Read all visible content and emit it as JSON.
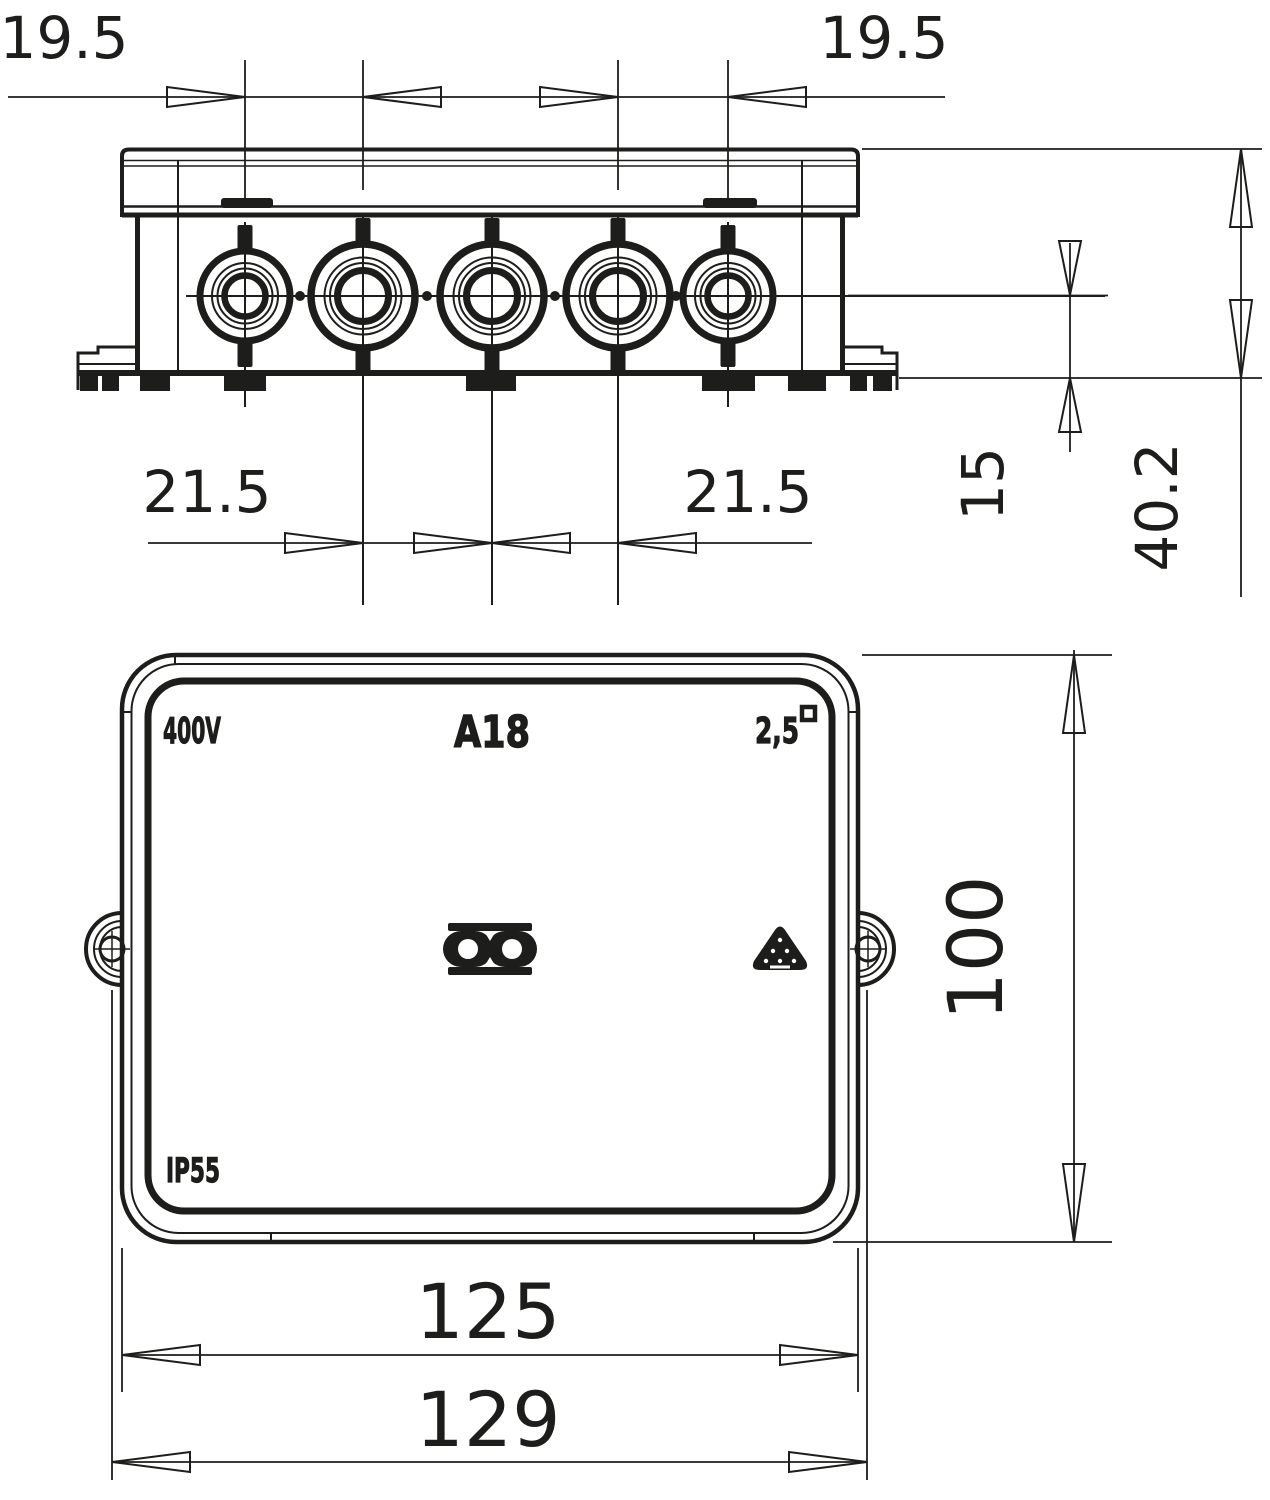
{
  "product": {
    "model": "A18",
    "voltage": "400V",
    "conductor_size": "2,5",
    "ip_rating": "IP55"
  },
  "symbols": [
    "obo-logo",
    "recycling-triangle",
    "conductor-square"
  ],
  "dimensions": {
    "side_view": {
      "grommet_spacing_top_left": "19.5",
      "grommet_spacing_top_right": "19.5",
      "grommet_spacing_bottom_left": "21.5",
      "grommet_spacing_bottom_right": "21.5",
      "base_to_entry_center": "15",
      "overall_height": "40.2"
    },
    "front_view": {
      "body_width": "125",
      "overall_width": "129",
      "body_height": "100"
    }
  },
  "colors": {
    "line": "#1d1d1b",
    "background": "#ffffff"
  }
}
